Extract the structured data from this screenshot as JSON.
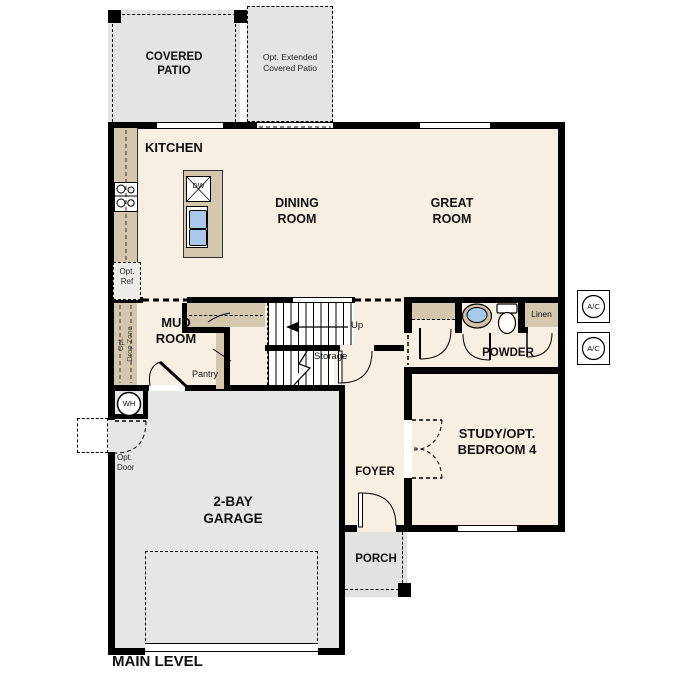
{
  "plan": {
    "title": "MAIN LEVEL",
    "labels": {
      "covered_patio": "COVERED\nPATIO",
      "opt_extended_patio": "Opt. Extended\nCovered Patio",
      "kitchen": "KITCHEN",
      "dining_room": "DINING\nROOM",
      "great_room": "GREAT\nROOM",
      "opt_ref": "Opt.\nRef",
      "opt_drop_zone": "Opt.\nDrop Zone",
      "mud_room": "MUD\nROOM",
      "pantry": "Pantry",
      "up": "Up",
      "storage": "Storage",
      "powder": "POWDER",
      "linen": "Linen",
      "study": "STUDY/OPT.\nBEDROOM 4",
      "foyer": "FOYER",
      "porch": "PORCH",
      "garage": "2-BAY\nGARAGE",
      "opt_door": "Opt.\nDoor",
      "wh": "WH",
      "dw": "DW",
      "ac": "A/C",
      "main_level": "MAIN LEVEL"
    },
    "colors": {
      "wall": "#000000",
      "floor": "#f7f0e2",
      "concrete": "#e5e5e3",
      "counter": "#d4c7ad",
      "sink_blue": "#a9c9ec",
      "background": "#ffffff"
    }
  }
}
